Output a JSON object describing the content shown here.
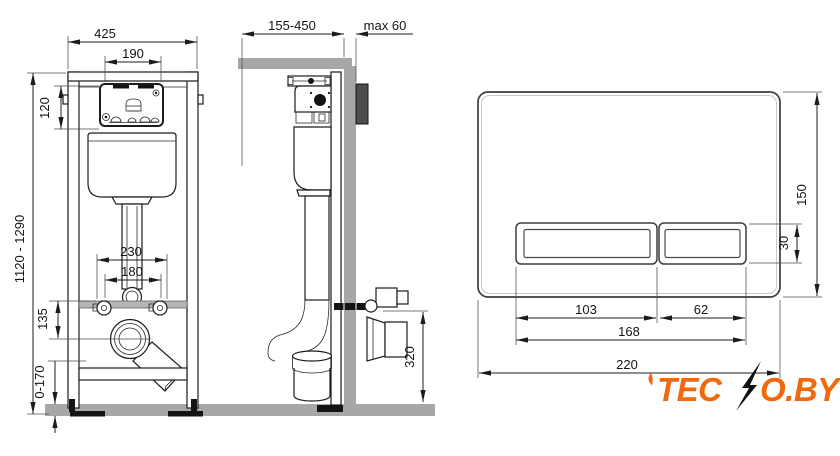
{
  "drawing_title": "concealed-wc-frame-installation-drawing",
  "front_view": {
    "dims": {
      "overall_width": "425",
      "opening_width": "190",
      "panel_height": "120",
      "install_height": "1120 - 1290",
      "bolt_spacing_wide": "230",
      "bolt_spacing_narrow": "180",
      "outlet_drop": "135",
      "foot_adjust": "0-170"
    }
  },
  "side_view": {
    "dims": {
      "depth_range": "155-450",
      "wall_thickness": "max 60",
      "outlet_height": "320"
    }
  },
  "flush_plate": {
    "dims": {
      "plate_height": "150",
      "button_height": "30",
      "large_button_width": "103",
      "small_button_width": "62",
      "buttons_width": "168",
      "plate_width": "220"
    }
  },
  "logo": {
    "part1": "TEC",
    "part2": "O.BY",
    "icon": "lightning-bolt",
    "color": "#f2690d"
  }
}
